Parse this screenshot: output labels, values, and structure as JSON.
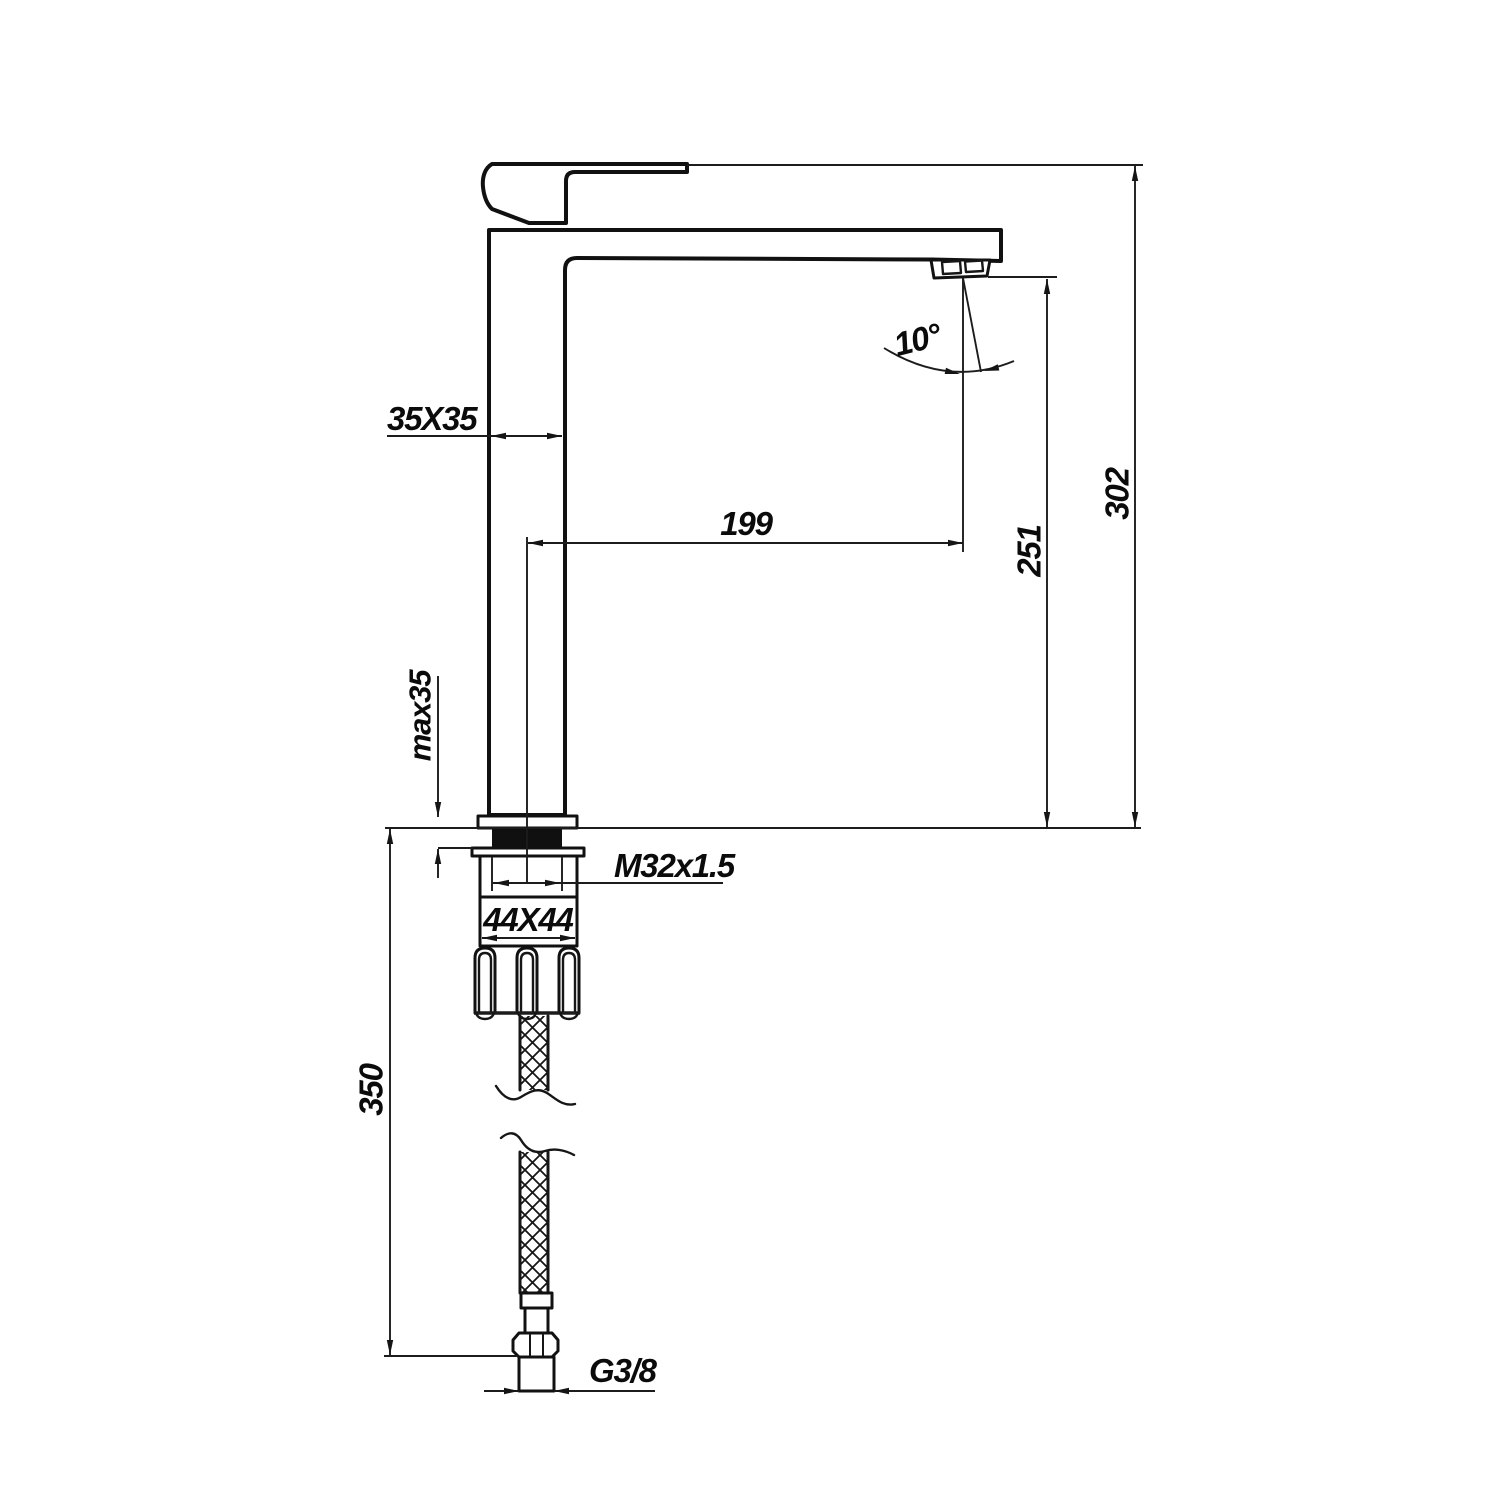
{
  "drawing": {
    "labels": {
      "body_section": "35X35",
      "spout_reach": "199",
      "spout_angle": "10°",
      "outlet_height": "251",
      "total_height": "302",
      "max_deck_thickness": "max35",
      "mounting_thread": "M32x1.5",
      "base_section": "44X44",
      "hose_length": "350",
      "hose_thread": "G3/8"
    }
  }
}
